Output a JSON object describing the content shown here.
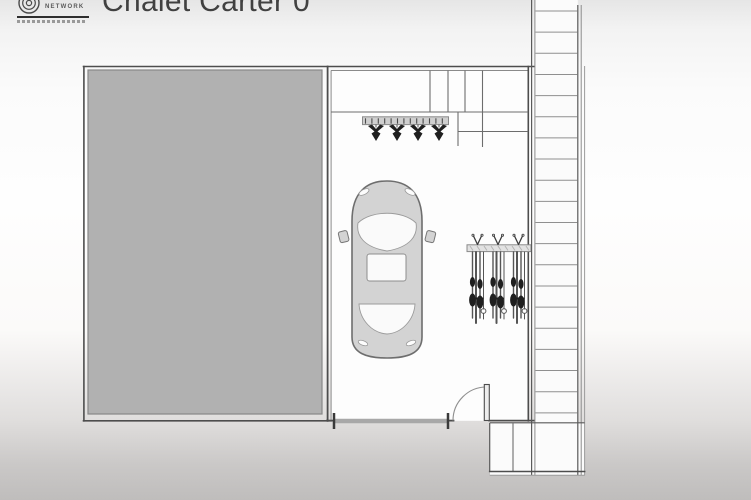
{
  "header": {
    "title": "Chalet Carter 0",
    "logo": {
      "label": "NETWORK"
    }
  },
  "plan": {
    "colors": {
      "wall": "#4d4d4d",
      "line_mid": "#6d6d6d",
      "line_light": "#8a8a8a",
      "slab_fill": "#b1b1b1",
      "slab_stroke": "#878787",
      "room_fill": "#fdfdfd",
      "car_body": "#d3d3d3",
      "car_glass": "#fafafa",
      "fixture": "#1f1f1f",
      "door_bar": "#a8a8a8"
    },
    "counts": {
      "stair_treads": 20,
      "downlights": 4,
      "ski_clusters": 3,
      "track_ticks": 13,
      "rack_ticks": 9
    }
  }
}
